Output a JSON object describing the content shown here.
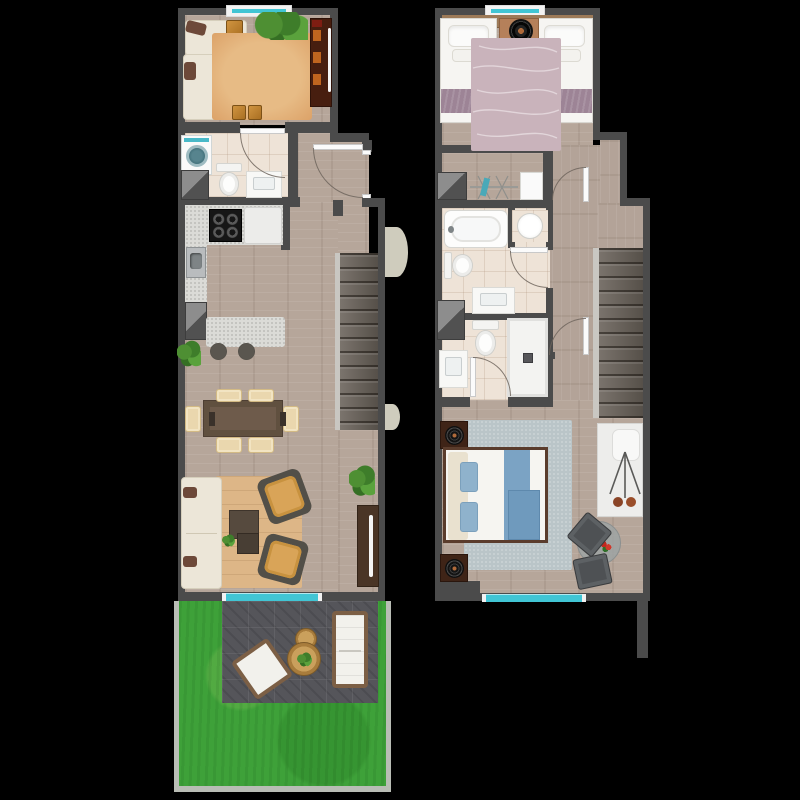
{
  "scene": {
    "description": "Top-down 3D rendered floor plan of a two-storey duplex apartment, shown as two plans side by side on a black background; no text labels are present in the image",
    "background_color": "#000000",
    "floor_count": 2
  },
  "palette": {
    "wall": "#4b4b4b",
    "wood_floor": "#b6a69a",
    "bathroom_tile": "#eee3d7",
    "stairs": "#645d56",
    "stair_rail": "#c9c7c2",
    "window_glass_teal": "#41c5d4",
    "window_frame": "#f2f2f2",
    "grass": "#3ea139",
    "patio_pavers": "#55555a",
    "garden_curb": "#b9bdb5",
    "salon_rug_terracotta": "#dca268",
    "living_rug_tan": "#ddb687",
    "twin_rug_mauve": "#c9b3bb",
    "master_rug_bluegray": "#bac5c8",
    "mauve_blanket": "#9d8496",
    "blue_bedding": "#7ba3c4",
    "sofa_cream": "#ece6d8",
    "armchair_mustard": "#d9a458",
    "wood_furniture": "#b5805a",
    "dark_console": "#471e0f",
    "granite_counter": "#dbdbd7",
    "outdoor_frame_brown": "#7c5f45",
    "door_swing_line": "#6e645c",
    "exterior_symbol_beige": "#cfccbd"
  },
  "floor1": {
    "label": "lower floor plan (left)",
    "rooms": [
      "studio-lounge",
      "bathroom-laundry",
      "kitchen",
      "dining-area",
      "living-room",
      "entry-hall",
      "staircase",
      "paved-terrace",
      "garden"
    ],
    "windows": [
      "top wall window",
      "bottom wall sliding window to terrace"
    ],
    "doors": [
      "entry door (right wall)",
      "bathroom door"
    ],
    "furniture": [
      "corner sofa with brown pillows",
      "wooden cube side tables x3",
      "terracotta area rug",
      "plant row under top window",
      "dark media console with shelves and TV",
      "washing machine",
      "toilet",
      "vanity sink",
      "service shaft x2",
      "granite kitchen counter",
      "black cooktop",
      "white refrigerator cabinet",
      "steel kitchen sink",
      "granite breakfast island",
      "bar stools x2",
      "potted plant x3",
      "dining table",
      "dining chairs x6",
      "cream sofa",
      "mustard armchairs x2",
      "coffee tables x2",
      "TV sideboard",
      "outdoor sofa",
      "outdoor chair",
      "round wooden side tables x2",
      "paved patio",
      "lawn"
    ]
  },
  "floor2": {
    "label": "upper floor plan (right)",
    "rooms": [
      "twin-bedroom",
      "wardrobe-corridor",
      "bathroom-with-tub",
      "shower-bathroom",
      "hallway",
      "staircase",
      "master-bedroom"
    ],
    "windows": [
      "top wall window",
      "bottom wall window"
    ],
    "doors": [
      "twin bedroom door",
      "tub bathroom door",
      "shower bathroom door",
      "master bedroom door"
    ],
    "furniture": [
      "single beds x2 with mauve blankets",
      "shared nightstand with round speaker",
      "mauve wave-pattern rug",
      "clothes rail with hangers",
      "wardrobe panel",
      "service shaft x2",
      "bathtub",
      "round basin",
      "toilets x2",
      "vanity sinks x2",
      "walk-in shower",
      "double bed with blue bedding",
      "dark nightstands x2 with decorative plates",
      "blue-gray rug",
      "white sideboard",
      "tripod floor lamp",
      "round glass table with flowers",
      "dark chairs x2"
    ]
  }
}
